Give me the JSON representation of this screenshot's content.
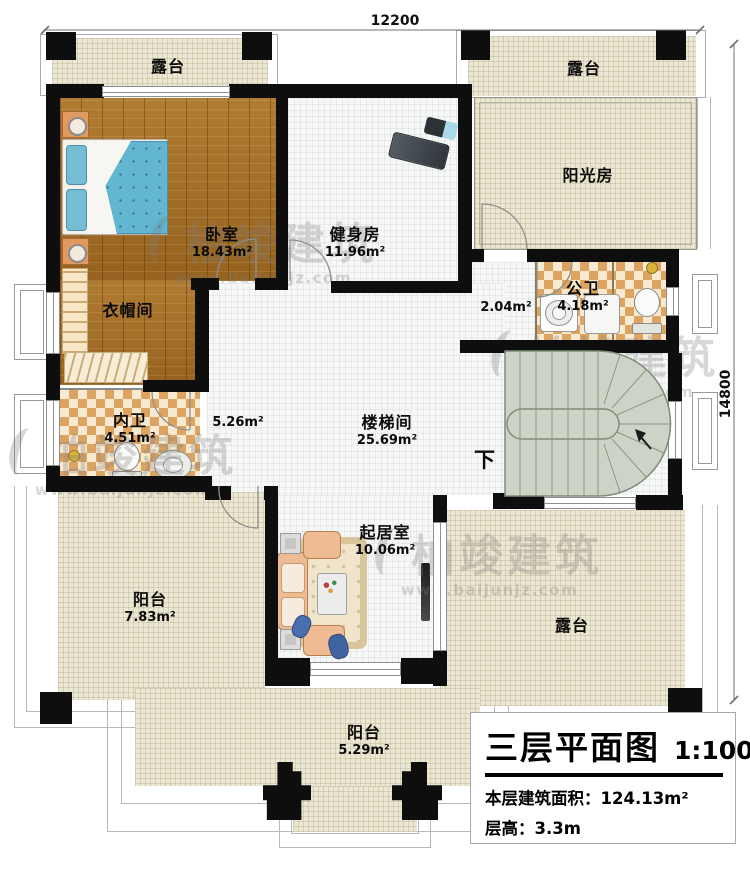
{
  "titleblock": {
    "title": "三层平面图",
    "scale": "1:100",
    "area_label": "本层建筑面积：",
    "area_value": "124.13m²",
    "floor_height_label": "层高：",
    "floor_height_value": "3.3m"
  },
  "dimensions": {
    "top": "12200",
    "right": "14800"
  },
  "watermark": {
    "brand": "柏竣建筑",
    "url": "www.baijunjz.com"
  },
  "rooms": [
    {
      "label": "露台"
    },
    {
      "label": "露台"
    },
    {
      "label": "卧室",
      "area": "18.43m²"
    },
    {
      "label": "健身房",
      "area": "11.96m²"
    },
    {
      "label": "阳光房"
    },
    {
      "label": "衣帽间"
    },
    {
      "label": "公卫",
      "area": "4.18m²"
    },
    {
      "area": "2.04m²"
    },
    {
      "label": "内卫",
      "area": "4.51m²"
    },
    {
      "area": "5.26m²"
    },
    {
      "label": "楼梯间",
      "area": "25.69m²"
    },
    {
      "label": "起居室",
      "area": "10.06m²"
    },
    {
      "label": "阳台",
      "area": "7.83m²"
    },
    {
      "label": "露台"
    },
    {
      "label": "阳台",
      "area": "5.29m²"
    },
    {
      "label": "下"
    }
  ]
}
